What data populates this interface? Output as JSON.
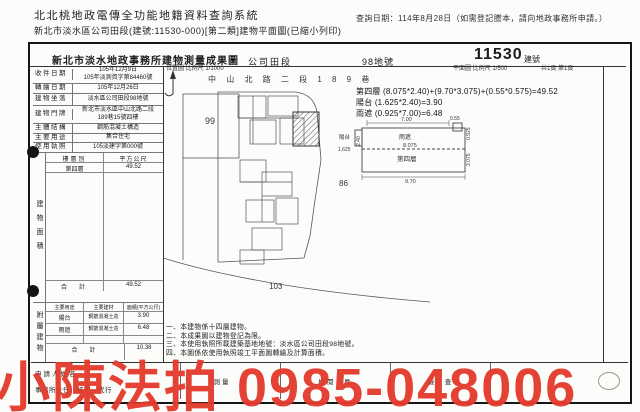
{
  "header": {
    "system_title": "北北桃地政電傳全功能地籍資料查詢系統",
    "query_date": "查詢日期：114年8月28日（如需登記謄本，請向地政事務所申請。）",
    "subtitle": "新北市淡水區公司田段(建號:11530-000)[第二類]建物平面圖(已縮小列印)"
  },
  "doc_header": {
    "office_title": "新北市淡水地政事務所建物測量成果圖",
    "section": "公司田段",
    "land_no": "98地號",
    "building_no": "11530",
    "building_no_label": "建號"
  },
  "info": {
    "rows": [
      {
        "label": "收件日期",
        "line1": "105年12月9日",
        "line2": "105年淡測資字第84460號"
      },
      {
        "label": "轉繪日期",
        "line1": "105年12月26日",
        "line2": ""
      },
      {
        "label": "建物坐落",
        "line1": "淡水區公司田段98地號",
        "line2": ""
      },
      {
        "label": "建物門牌",
        "line1": "新北市淡水區中山北路二段",
        "line2": "189巷15號四樓"
      },
      {
        "label": "主體結構",
        "line1": "鋼筋混凝土構造",
        "line2": ""
      },
      {
        "label": "主要用途",
        "line1": "集合住宅",
        "line2": ""
      },
      {
        "label": "使用執照",
        "line1": "105淡建字第000號",
        "line2": ""
      }
    ]
  },
  "area": {
    "side_label": "建物面積",
    "col_floor": "樓層別",
    "col_unit": "平方公尺",
    "rows": [
      {
        "floor": "第四層",
        "value": "49.52"
      }
    ],
    "total_label": "合　計",
    "total": "49.52"
  },
  "annex": {
    "side_label": "附屬建物",
    "h_use": "主要用途",
    "h_mat": "主要建材",
    "h_area": "面積(平方公尺)",
    "rows": [
      {
        "use": "陽台",
        "mat": "鋼筋混凝土造",
        "value": "3.90"
      },
      {
        "use": "雨遮",
        "mat": "鋼筋混凝土造",
        "value": "6.48"
      }
    ],
    "total_label": "合　計",
    "total": "10.38"
  },
  "notes": [
    "一、本建物係十四層建物。",
    "二、本成果圖以建物登記為限。",
    "三、本使用執照所載建築基地地號：淡水區公司田段98地號。",
    "四、本圖係依使用執照竣工平面圖轉繪及計算面積。"
  ],
  "calc": [
    "第四層 (8.075*2.40)+(9.70*3.075)+(0.55*0.575)=49.52",
    "陽台 (1.625*2.40)=3.90",
    "雨遮 (0.925*7.00)=6.48"
  ],
  "map": {
    "location_label": "位置圖 比例尺 1/1000",
    "plan_label": "平面圖 比例尺 1/500",
    "page_label": "共1頁 第1頁",
    "road": "中 山 北 路 二 段 1 8 9 巷",
    "parcel_99": "99",
    "parcel_86": "86",
    "parcel_103": "103"
  },
  "plan": {
    "canopy": "雨遮",
    "balcony": "陽台",
    "floor": "第四層",
    "d_top": "7.00",
    "d_corner": "0.55",
    "d_balcony": "1.625",
    "d_left": "2.40",
    "d_mid": "8.075",
    "d_right_top": "0.925",
    "d_right": "3.075",
    "d_bottom": "9.70"
  },
  "footer": {
    "applicant": "申請人姓名",
    "chief": "事務所主任　核定　代行",
    "surveyor": "測量　員",
    "reviewer": "檢閱　員",
    "checker": "檢　查"
  },
  "watermark": {
    "text": "小陳法拍 0985-048006",
    "color": "#e23b2e"
  }
}
